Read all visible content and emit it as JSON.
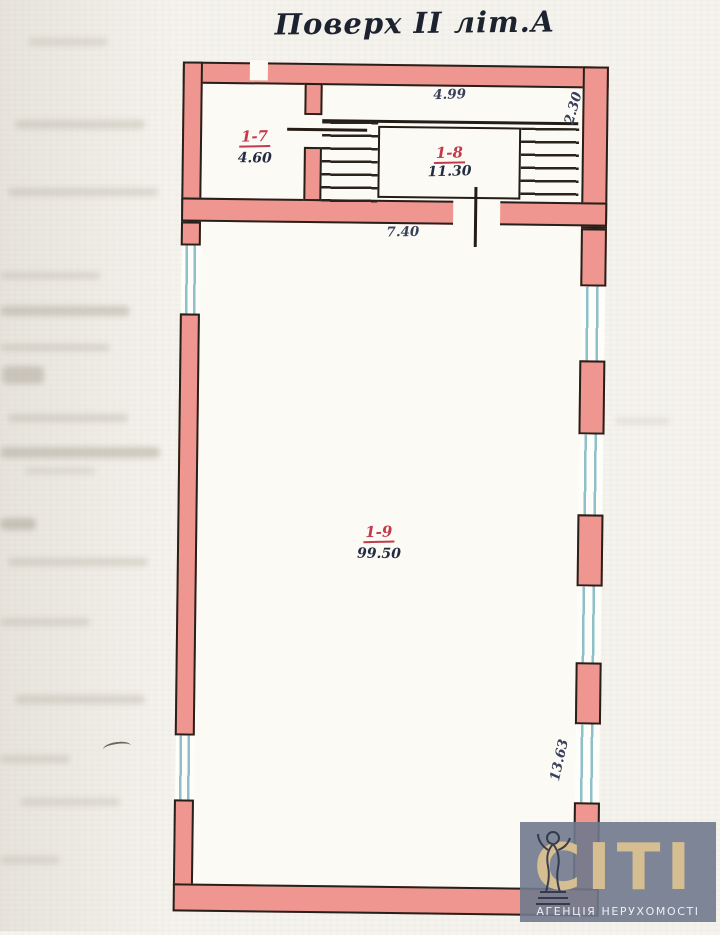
{
  "title": "Поверх II літ.А",
  "rooms": [
    {
      "id": "1-7",
      "label": "1-7",
      "area": "4.60"
    },
    {
      "id": "1-8",
      "label": "1-8",
      "area": "11.30"
    },
    {
      "id": "1-9",
      "label": "1-9",
      "area": "99.50"
    }
  ],
  "dimensions": {
    "top_width": "4.99",
    "top_right_depth": "2.30",
    "entry_width": "7.40",
    "right_side_length": "13.63"
  },
  "watermark": {
    "brand": "СІТІ",
    "tagline": "АГЕНЦІЯ НЕРУХОМОСТІ",
    "icon": "statue-icon"
  },
  "colors": {
    "wall_fill": "#ee968f",
    "wall_outline": "#27201a",
    "window_line": "#8fbfc9",
    "room_label": "#c13b4b",
    "dimension_text": "#39405c",
    "watermark_bg": "#70798d",
    "brand_text": "#d5be92"
  }
}
